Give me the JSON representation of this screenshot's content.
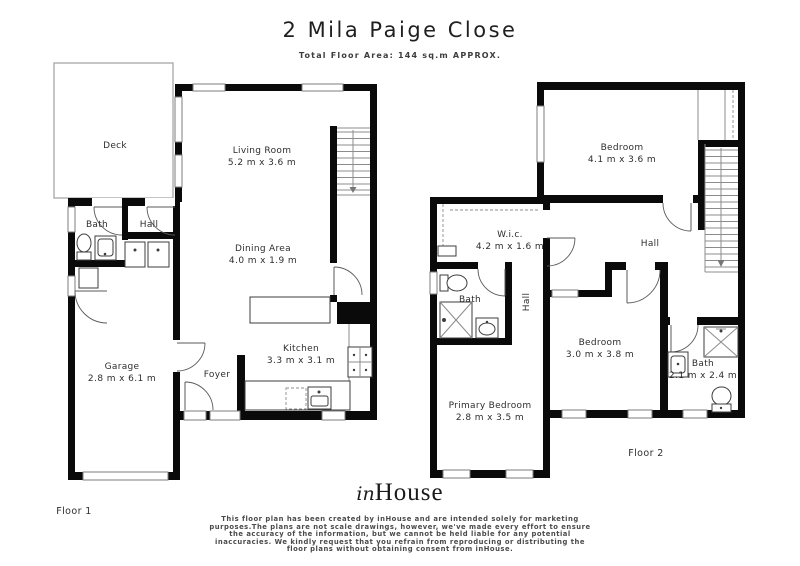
{
  "header": {
    "title": "2 Mila Paige Close",
    "subtitle": "Total Floor Area: 144 sq.m APPROX."
  },
  "floor1": {
    "label": "Floor 1",
    "rooms": {
      "deck": {
        "name": "Deck"
      },
      "living": {
        "name": "Living Room",
        "dims": "5.2 m x 3.6 m"
      },
      "bath": {
        "name": "Bath"
      },
      "hall": {
        "name": "Hall"
      },
      "dining": {
        "name": "Dining Area",
        "dims": "4.0 m x 1.9 m"
      },
      "garage": {
        "name": "Garage",
        "dims": "2.8 m x 6.1 m"
      },
      "foyer": {
        "name": "Foyer"
      },
      "kitchen": {
        "name": "Kitchen",
        "dims": "3.3 m x 3.1 m"
      }
    }
  },
  "floor2": {
    "label": "Floor 2",
    "rooms": {
      "bedroom1": {
        "name": "Bedroom",
        "dims": "4.1 m x 3.6 m"
      },
      "wic": {
        "name": "W.i.c.",
        "dims": "4.2 m x 1.6 m"
      },
      "hall": {
        "name": "Hall"
      },
      "bath_left": {
        "name": "Bath"
      },
      "hall_vertical": {
        "name": "Hall"
      },
      "bedroom2": {
        "name": "Bedroom",
        "dims": "3.0 m x 3.8 m"
      },
      "bath_right": {
        "name": "Bath",
        "dims": "2.1 m x 2.4 m"
      },
      "primary": {
        "name": "Primary Bedroom",
        "dims": "2.8 m x 3.5 m"
      }
    }
  },
  "footer": {
    "logo_in": "in",
    "logo_house": "House",
    "disclaimer_lines": [
      "This floor plan has been created by inHouse and are intended solely for marketing",
      "purposes.The plans are not scale drawings, however, we've made every effort to ensure",
      "the accuracy of the information, but we cannot be held liable for any potential",
      "inaccuracies. We kindly request that you refrain from reproducing or distributing the",
      "floor plans without obtaining consent from inHouse."
    ]
  },
  "colors": {
    "wall": "#0a0a0a",
    "text": "#2e2e2e",
    "thin_line": "#8c8c8c",
    "background": "#ffffff"
  }
}
